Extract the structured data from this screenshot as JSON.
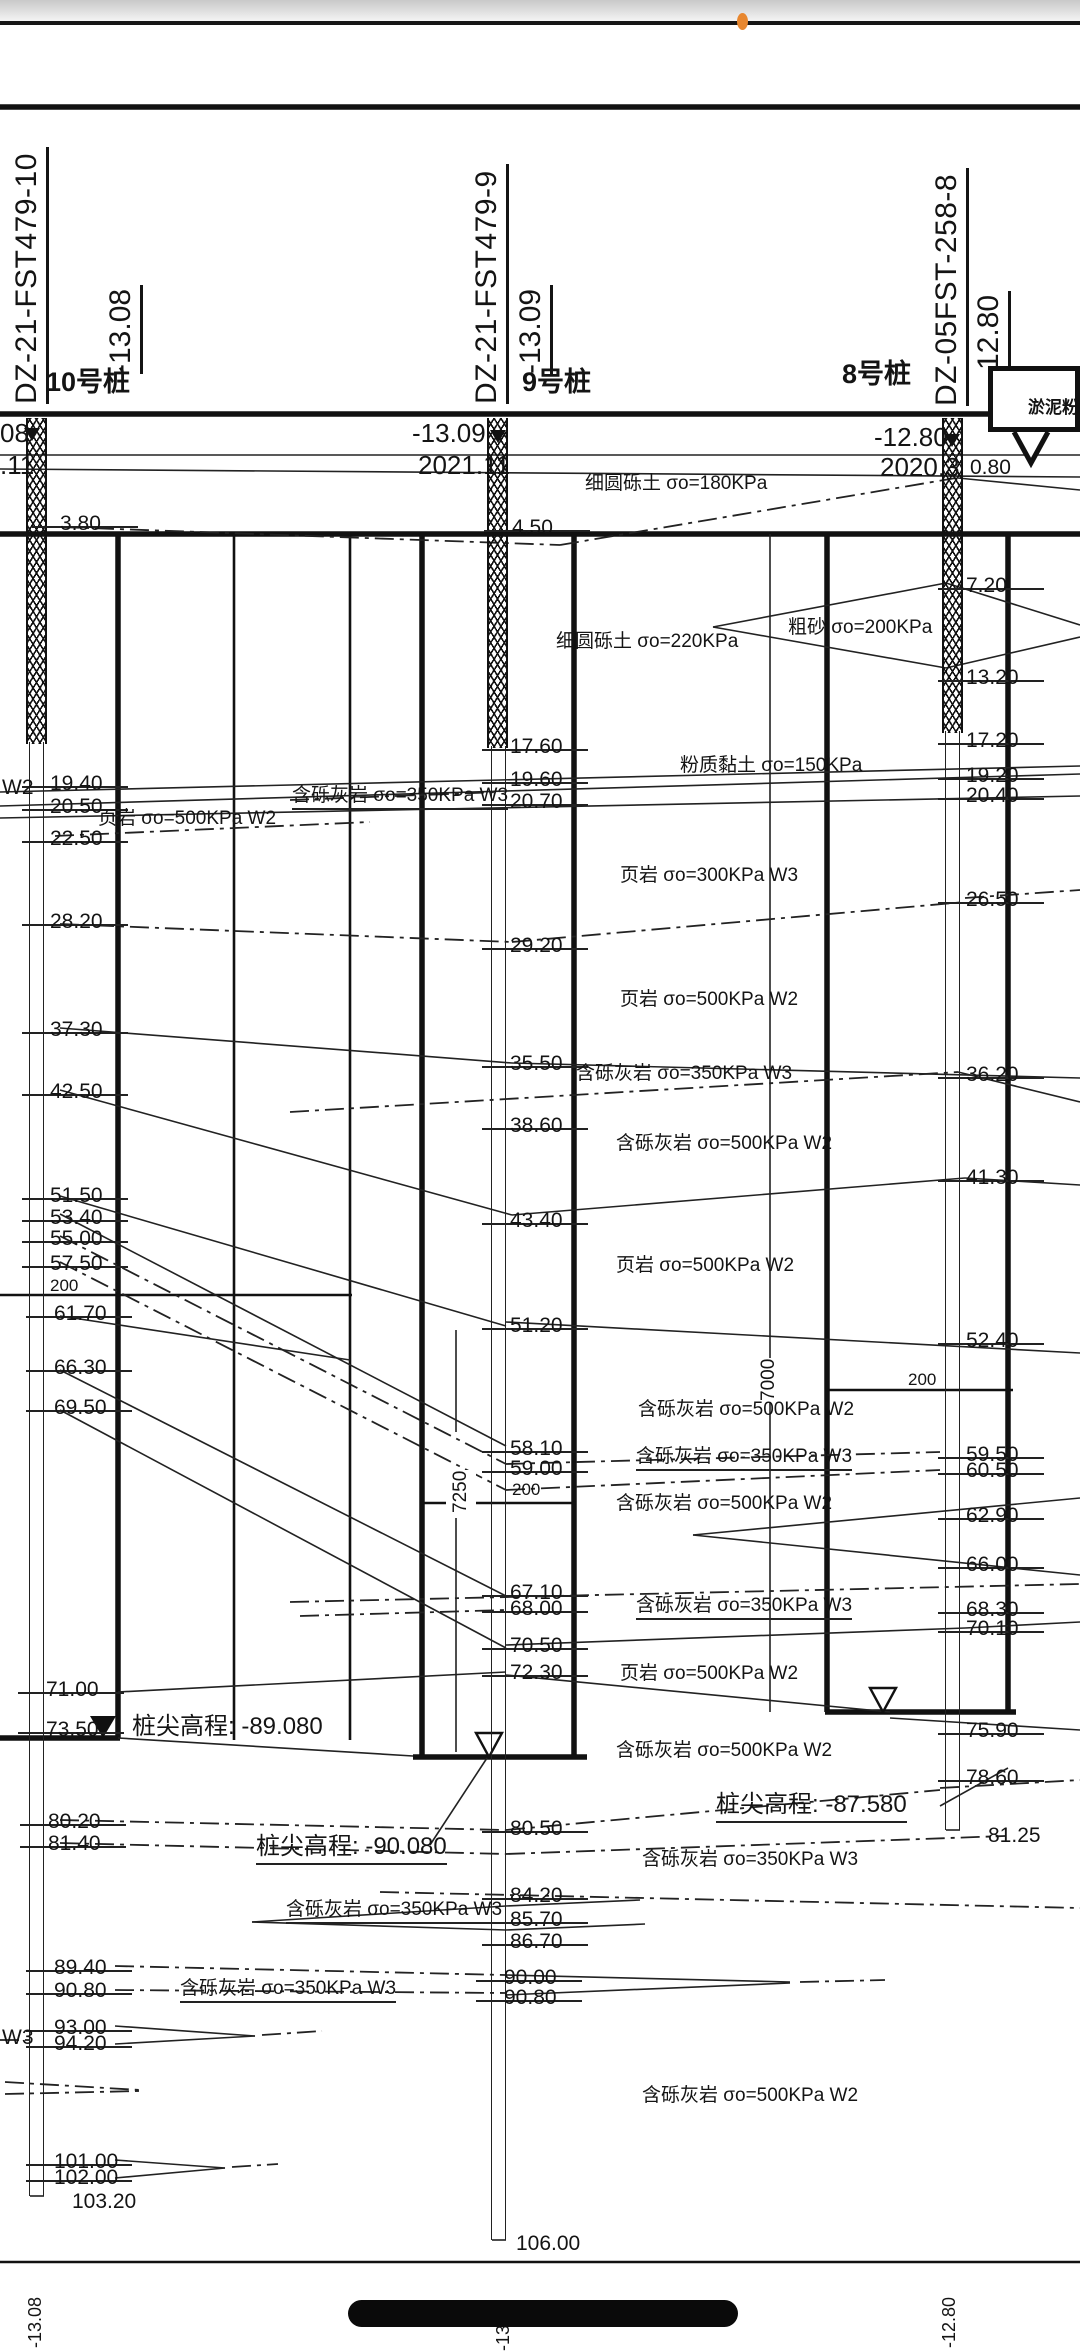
{
  "status_bar": {
    "dot_color": "#E8872F"
  },
  "boreholes": [
    {
      "id": "DZ-21-FST479-10",
      "elevation": "-13.08",
      "pile": "10号桩",
      "surface_clip": "08",
      "date_clip": ".11",
      "head_elevation": "-13.08",
      "head_date": "2021.11"
    },
    {
      "id": "DZ-21-FST479-9",
      "elevation": "-13.09",
      "pile": "9号桩",
      "head_elevation": "-13.09",
      "head_date": "2021.11"
    },
    {
      "id": "DZ-05FST-258-8",
      "elevation": "-12.80",
      "pile": "8号桩",
      "head_elevation": "-12.80",
      "head_date": "2020.3"
    }
  ],
  "callout": {
    "text": "淤泥粉"
  },
  "pile_tips": [
    {
      "label": "桩尖高程: -89.080"
    },
    {
      "label": "桩尖高程: -90.080"
    },
    {
      "label": "桩尖高程: -87.580"
    }
  ],
  "dims": [
    {
      "t": "7250"
    },
    {
      "t": "7000"
    }
  ],
  "bottom_labels": [
    "-13.08",
    "-13.09",
    "-12.80"
  ],
  "depth_labels": [
    {
      "t": "3.80",
      "x": 60,
      "y": 512
    },
    {
      "t": "W2",
      "x": 2,
      "y": 776,
      "nt": true
    },
    {
      "t": "19.40",
      "x": 50,
      "y": 772
    },
    {
      "t": "20.50",
      "x": 50,
      "y": 795
    },
    {
      "t": "22.50",
      "x": 50,
      "y": 827
    },
    {
      "t": "28.20",
      "x": 50,
      "y": 910
    },
    {
      "t": "37.30",
      "x": 50,
      "y": 1018
    },
    {
      "t": "42.50",
      "x": 50,
      "y": 1080
    },
    {
      "t": "51.50",
      "x": 50,
      "y": 1184
    },
    {
      "t": "53.40",
      "x": 50,
      "y": 1206
    },
    {
      "t": "55.00",
      "x": 50,
      "y": 1227
    },
    {
      "t": "57.50",
      "x": 50,
      "y": 1252
    },
    {
      "t": "200",
      "x": 50,
      "y": 1276,
      "sm": true,
      "nt": true
    },
    {
      "t": "61.70",
      "x": 54,
      "y": 1302
    },
    {
      "t": "66.30",
      "x": 54,
      "y": 1356
    },
    {
      "t": "69.50",
      "x": 54,
      "y": 1396
    },
    {
      "t": "71.00",
      "x": 46,
      "y": 1678
    },
    {
      "t": "73.50",
      "x": 46,
      "y": 1718
    },
    {
      "t": "80.20",
      "x": 48,
      "y": 1810
    },
    {
      "t": "81.40",
      "x": 48,
      "y": 1832
    },
    {
      "t": "89.40",
      "x": 54,
      "y": 1956
    },
    {
      "t": "90.80",
      "x": 54,
      "y": 1979
    },
    {
      "t": "93.00",
      "x": 54,
      "y": 2016
    },
    {
      "t": "94.20",
      "x": 54,
      "y": 2032
    },
    {
      "t": "W3",
      "x": 2,
      "y": 2026,
      "nt": true
    },
    {
      "t": "101.00",
      "x": 54,
      "y": 2150
    },
    {
      "t": "102.00",
      "x": 54,
      "y": 2166
    },
    {
      "t": "103.20",
      "x": 72,
      "y": 2190,
      "nt": true
    },
    {
      "t": "4.50",
      "x": 512,
      "y": 516
    },
    {
      "t": "17.60",
      "x": 510,
      "y": 735
    },
    {
      "t": "19.60",
      "x": 510,
      "y": 768
    },
    {
      "t": "20.70",
      "x": 510,
      "y": 790
    },
    {
      "t": "29.20",
      "x": 510,
      "y": 934
    },
    {
      "t": "35.50",
      "x": 510,
      "y": 1052
    },
    {
      "t": "38.60",
      "x": 510,
      "y": 1114
    },
    {
      "t": "43.40",
      "x": 510,
      "y": 1209
    },
    {
      "t": "51.20",
      "x": 510,
      "y": 1314
    },
    {
      "t": "58.10",
      "x": 510,
      "y": 1437
    },
    {
      "t": "59.00",
      "x": 510,
      "y": 1457
    },
    {
      "t": "200",
      "x": 512,
      "y": 1480,
      "sm": true,
      "nt": true
    },
    {
      "t": "67.10",
      "x": 510,
      "y": 1581
    },
    {
      "t": "68.00",
      "x": 510,
      "y": 1597
    },
    {
      "t": "70.50",
      "x": 510,
      "y": 1634
    },
    {
      "t": "72.30",
      "x": 510,
      "y": 1661
    },
    {
      "t": "80.50",
      "x": 510,
      "y": 1817
    },
    {
      "t": "84.20",
      "x": 510,
      "y": 1884
    },
    {
      "t": "85.70",
      "x": 510,
      "y": 1908
    },
    {
      "t": "86.70",
      "x": 510,
      "y": 1930
    },
    {
      "t": "90.00",
      "x": 504,
      "y": 1966
    },
    {
      "t": "90.80",
      "x": 504,
      "y": 1986
    },
    {
      "t": "106.00",
      "x": 516,
      "y": 2232,
      "nt": true
    },
    {
      "t": "0.80",
      "x": 970,
      "y": 456,
      "nt": true
    },
    {
      "t": "7.20",
      "x": 966,
      "y": 574
    },
    {
      "t": "13.20",
      "x": 966,
      "y": 666
    },
    {
      "t": "17.20",
      "x": 966,
      "y": 729
    },
    {
      "t": "19.20",
      "x": 966,
      "y": 764
    },
    {
      "t": "20.40",
      "x": 966,
      "y": 784
    },
    {
      "t": "26.50",
      "x": 966,
      "y": 888
    },
    {
      "t": "36.20",
      "x": 966,
      "y": 1063
    },
    {
      "t": "41.30",
      "x": 966,
      "y": 1166
    },
    {
      "t": "52.40",
      "x": 966,
      "y": 1329
    },
    {
      "t": "200",
      "x": 908,
      "y": 1370,
      "sm": true,
      "nt": true
    },
    {
      "t": "59.50",
      "x": 966,
      "y": 1443
    },
    {
      "t": "60.50",
      "x": 966,
      "y": 1459
    },
    {
      "t": "62.90",
      "x": 966,
      "y": 1504
    },
    {
      "t": "66.00",
      "x": 966,
      "y": 1553
    },
    {
      "t": "68.30",
      "x": 966,
      "y": 1598
    },
    {
      "t": "70.10",
      "x": 966,
      "y": 1617
    },
    {
      "t": "75.90",
      "x": 966,
      "y": 1719
    },
    {
      "t": "78.60",
      "x": 966,
      "y": 1766
    },
    {
      "t": "81.25",
      "x": 988,
      "y": 1824,
      "nt": true
    }
  ],
  "strata_labels": [
    {
      "t": "细圆砾土 σo=180KPa",
      "x": 585,
      "y": 468
    },
    {
      "t": "细圆砾土 σo=220KPa",
      "x": 556,
      "y": 626
    },
    {
      "t": "粗砂 σo=200KPa",
      "x": 788,
      "y": 612
    },
    {
      "t": "粉质黏土 σo=150KPa",
      "x": 680,
      "y": 750
    },
    {
      "t": "含砾灰岩 σo=350KPa W3",
      "x": 292,
      "y": 780,
      "u": true
    },
    {
      "t": "页岩  σo=500KPa W2",
      "x": 98,
      "y": 803
    },
    {
      "t": "页岩  σo=300KPa W3",
      "x": 620,
      "y": 860
    },
    {
      "t": "页岩  σo=500KPa W2",
      "x": 620,
      "y": 984
    },
    {
      "t": "含砾灰岩 σo=350KPa W3",
      "x": 576,
      "y": 1058
    },
    {
      "t": "含砾灰岩 σo=500KPa W2",
      "x": 616,
      "y": 1128
    },
    {
      "t": "页岩  σo=500KPa W2",
      "x": 616,
      "y": 1250
    },
    {
      "t": "含砾灰岩 σo=500KPa W2",
      "x": 638,
      "y": 1394
    },
    {
      "t": "含砾灰岩 σo=350KPa W3",
      "x": 636,
      "y": 1441,
      "u": true
    },
    {
      "t": "含砾灰岩 σo=500KPa W2",
      "x": 616,
      "y": 1488
    },
    {
      "t": "含砾灰岩 σo=350KPa W3",
      "x": 636,
      "y": 1590,
      "u": true
    },
    {
      "t": "页岩  σo=500KPa W2",
      "x": 620,
      "y": 1658
    },
    {
      "t": "含砾灰岩 σo=500KPa W2",
      "x": 616,
      "y": 1735
    },
    {
      "t": "含砾灰岩 σo=350KPa W3",
      "x": 642,
      "y": 1844
    },
    {
      "t": "含砾灰岩 σo=350KPa W3",
      "x": 286,
      "y": 1894,
      "u": true
    },
    {
      "t": "含砾灰岩 σo=350KPa W3",
      "x": 180,
      "y": 1973,
      "u": true
    },
    {
      "t": "含砾灰岩 σo=500KPa W2",
      "x": 642,
      "y": 2080
    }
  ]
}
